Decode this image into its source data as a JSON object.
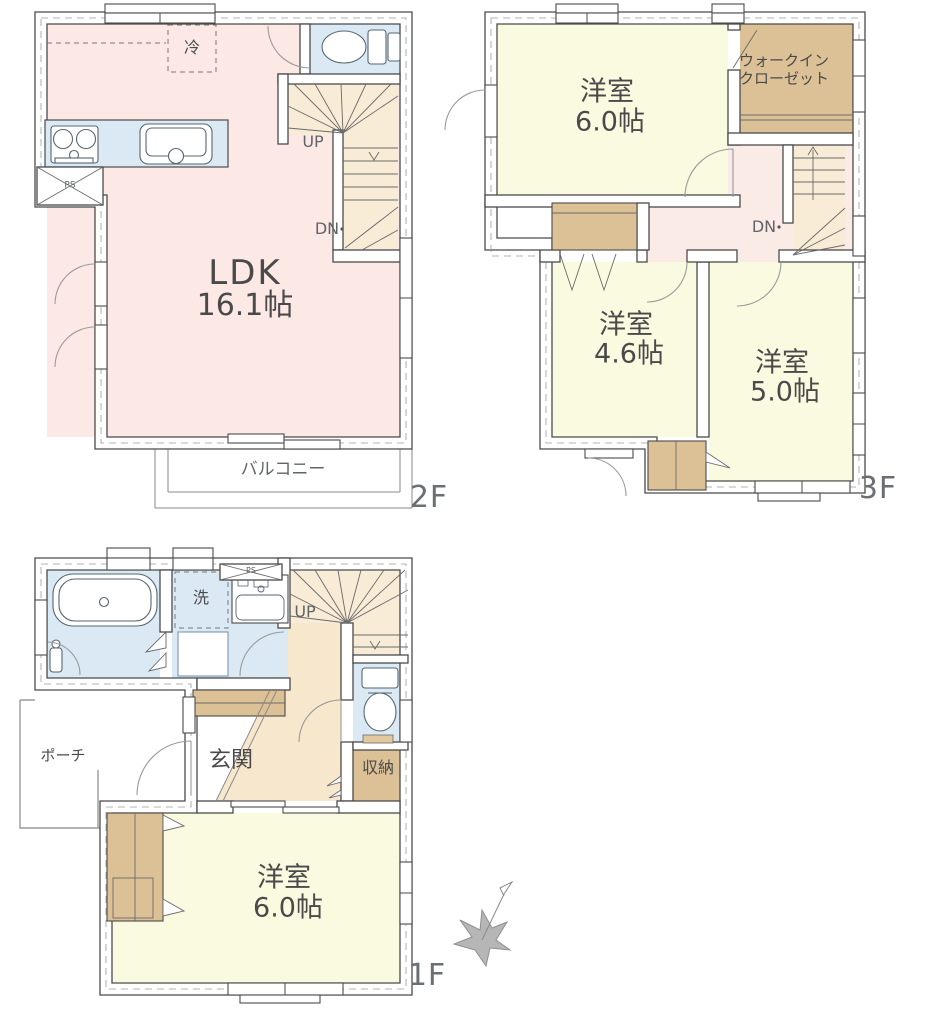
{
  "colors": {
    "room_pink": "#fce9e6",
    "room_yellow": "#fafae0",
    "water_blue": "#dbe9f5",
    "stair_tan": "#f9ecd7",
    "hall_tan": "#f6e7cd",
    "hall_pink": "#fbebe6",
    "closet_brown": "#dcc096",
    "wall_line": "#4a4a4a",
    "text_gray": "#4a4a4a"
  },
  "floor_2f": {
    "floor_label": "2F",
    "ldk_name": "LDK",
    "ldk_size": "16.1帖",
    "balcony_label": "バルコニー",
    "fridge_label": "冷",
    "stairs_up_label": "UP",
    "stairs_down_label": "DN",
    "pipe_space_label": "PS"
  },
  "floor_3f": {
    "floor_label": "3F",
    "bedroom1_name": "洋室",
    "bedroom1_size": "6.0帖",
    "wic_line1": "ウォークイン",
    "wic_line2": "クローゼット",
    "stairs_down_label": "DN",
    "bedroom2_name": "洋室",
    "bedroom2_size": "4.6帖",
    "bedroom3_name": "洋室",
    "bedroom3_size": "5.0帖"
  },
  "floor_1f": {
    "floor_label": "1F",
    "laundry_label": "洗",
    "pipe_space_label": "PS",
    "stairs_up_label": "UP",
    "porch_label": "ポーチ",
    "entrance_label": "玄関",
    "storage_label": "収納",
    "bedroom_name": "洋室",
    "bedroom_size": "6.0帖"
  }
}
